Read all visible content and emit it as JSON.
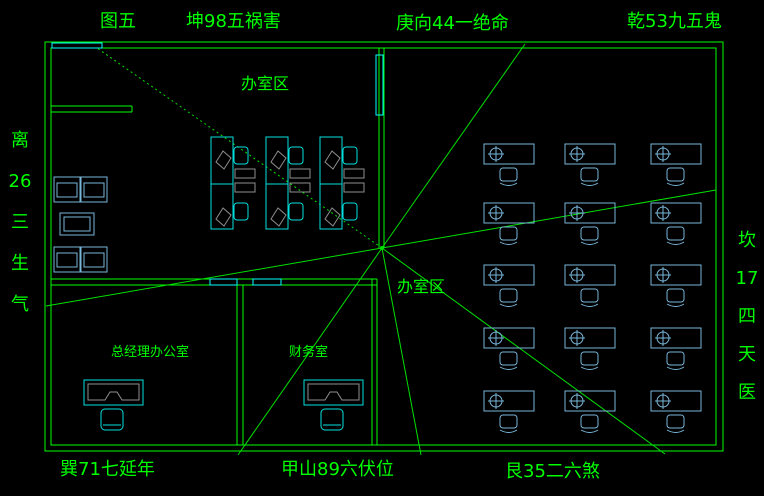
{
  "title": "办公室风水布局图",
  "figure_label": "图五",
  "compass": {
    "top_left": "坤98五祸害",
    "top_center": "庚向44一绝命",
    "top_right": "乾53九五鬼",
    "left_vertical": "离\n26\n三\n生\n气",
    "right_vertical": "坎\n17\n四\n天\n医",
    "bottom_left": "巽71七延年",
    "bottom_center": "甲山89六伏位",
    "bottom_right": "艮35二六煞"
  },
  "rooms": {
    "office_area_top": "办室区",
    "office_area_center": "办室区",
    "manager_office": "总经理办公室",
    "finance_room": "财务室"
  },
  "colors": {
    "background": "#000000",
    "line_green": "#00ff00",
    "window_cyan": "#00ffff",
    "furniture_cyan": "#00e0e0",
    "furniture_blue": "#79b6d9",
    "furniture_gray": "#8f8f8f"
  }
}
